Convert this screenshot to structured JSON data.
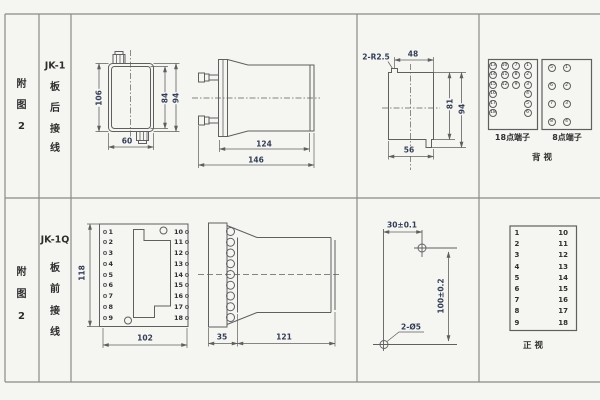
{
  "meta": {
    "bg": "#f5f5f2",
    "grid_line": "#8a8a8a",
    "drawing_line": "#5f5f5f",
    "text_color": "#2e2e2e",
    "dim_color": "#333d55"
  },
  "cells": {
    "fig1": [
      "附",
      "图",
      "2"
    ],
    "model1": "JK-1",
    "wiring1": [
      "板",
      "后",
      "接",
      "线"
    ],
    "fig2": [
      "附",
      "图",
      "2"
    ],
    "model2": "JK-1Q",
    "wiring2": [
      "板",
      "前",
      "接",
      "线"
    ]
  },
  "row1": {
    "plan": {
      "height": "106",
      "inner_height": "84",
      "outer_height": "94",
      "width": "60"
    },
    "side": {
      "body_len": "124",
      "total_len": "146"
    },
    "cutout": {
      "corner": "2-R2.5",
      "top_width": "48",
      "inner_height": "81",
      "outer_height": "94",
      "bottom_width": "56"
    },
    "rear": {
      "t18_label": "18点端子",
      "t8_label": "8点端子",
      "view_label": "背 视",
      "t18": {
        "col1": [
          "13",
          "14",
          "15",
          "16",
          "17",
          "18"
        ],
        "col2": [
          "10",
          "11",
          "12"
        ],
        "col3": [
          "7",
          "8",
          "9"
        ],
        "col4": [
          "1",
          "2",
          "3",
          "4",
          "5",
          "6"
        ]
      },
      "t8": {
        "left": [
          "5",
          "6",
          "7",
          "8"
        ],
        "right": [
          "1",
          "2",
          "3",
          "4"
        ]
      }
    }
  },
  "row2": {
    "plate": {
      "height": "118",
      "width": "102",
      "left": [
        "1",
        "2",
        "3",
        "4",
        "5",
        "6",
        "7",
        "8",
        "9"
      ],
      "right": [
        "10",
        "11",
        "12",
        "13",
        "14",
        "15",
        "16",
        "17",
        "18"
      ]
    },
    "side": {
      "plate_th": "35",
      "body_len": "121"
    },
    "drill": {
      "hspace": "30±0.1",
      "vspace": "100±0.2",
      "holes": "2-Ø5"
    },
    "front": {
      "left": [
        "1",
        "2",
        "3",
        "4",
        "5",
        "6",
        "7",
        "8",
        "9"
      ],
      "right": [
        "10",
        "11",
        "12",
        "13",
        "14",
        "15",
        "16",
        "17",
        "18"
      ],
      "view_label": "正 视"
    }
  }
}
